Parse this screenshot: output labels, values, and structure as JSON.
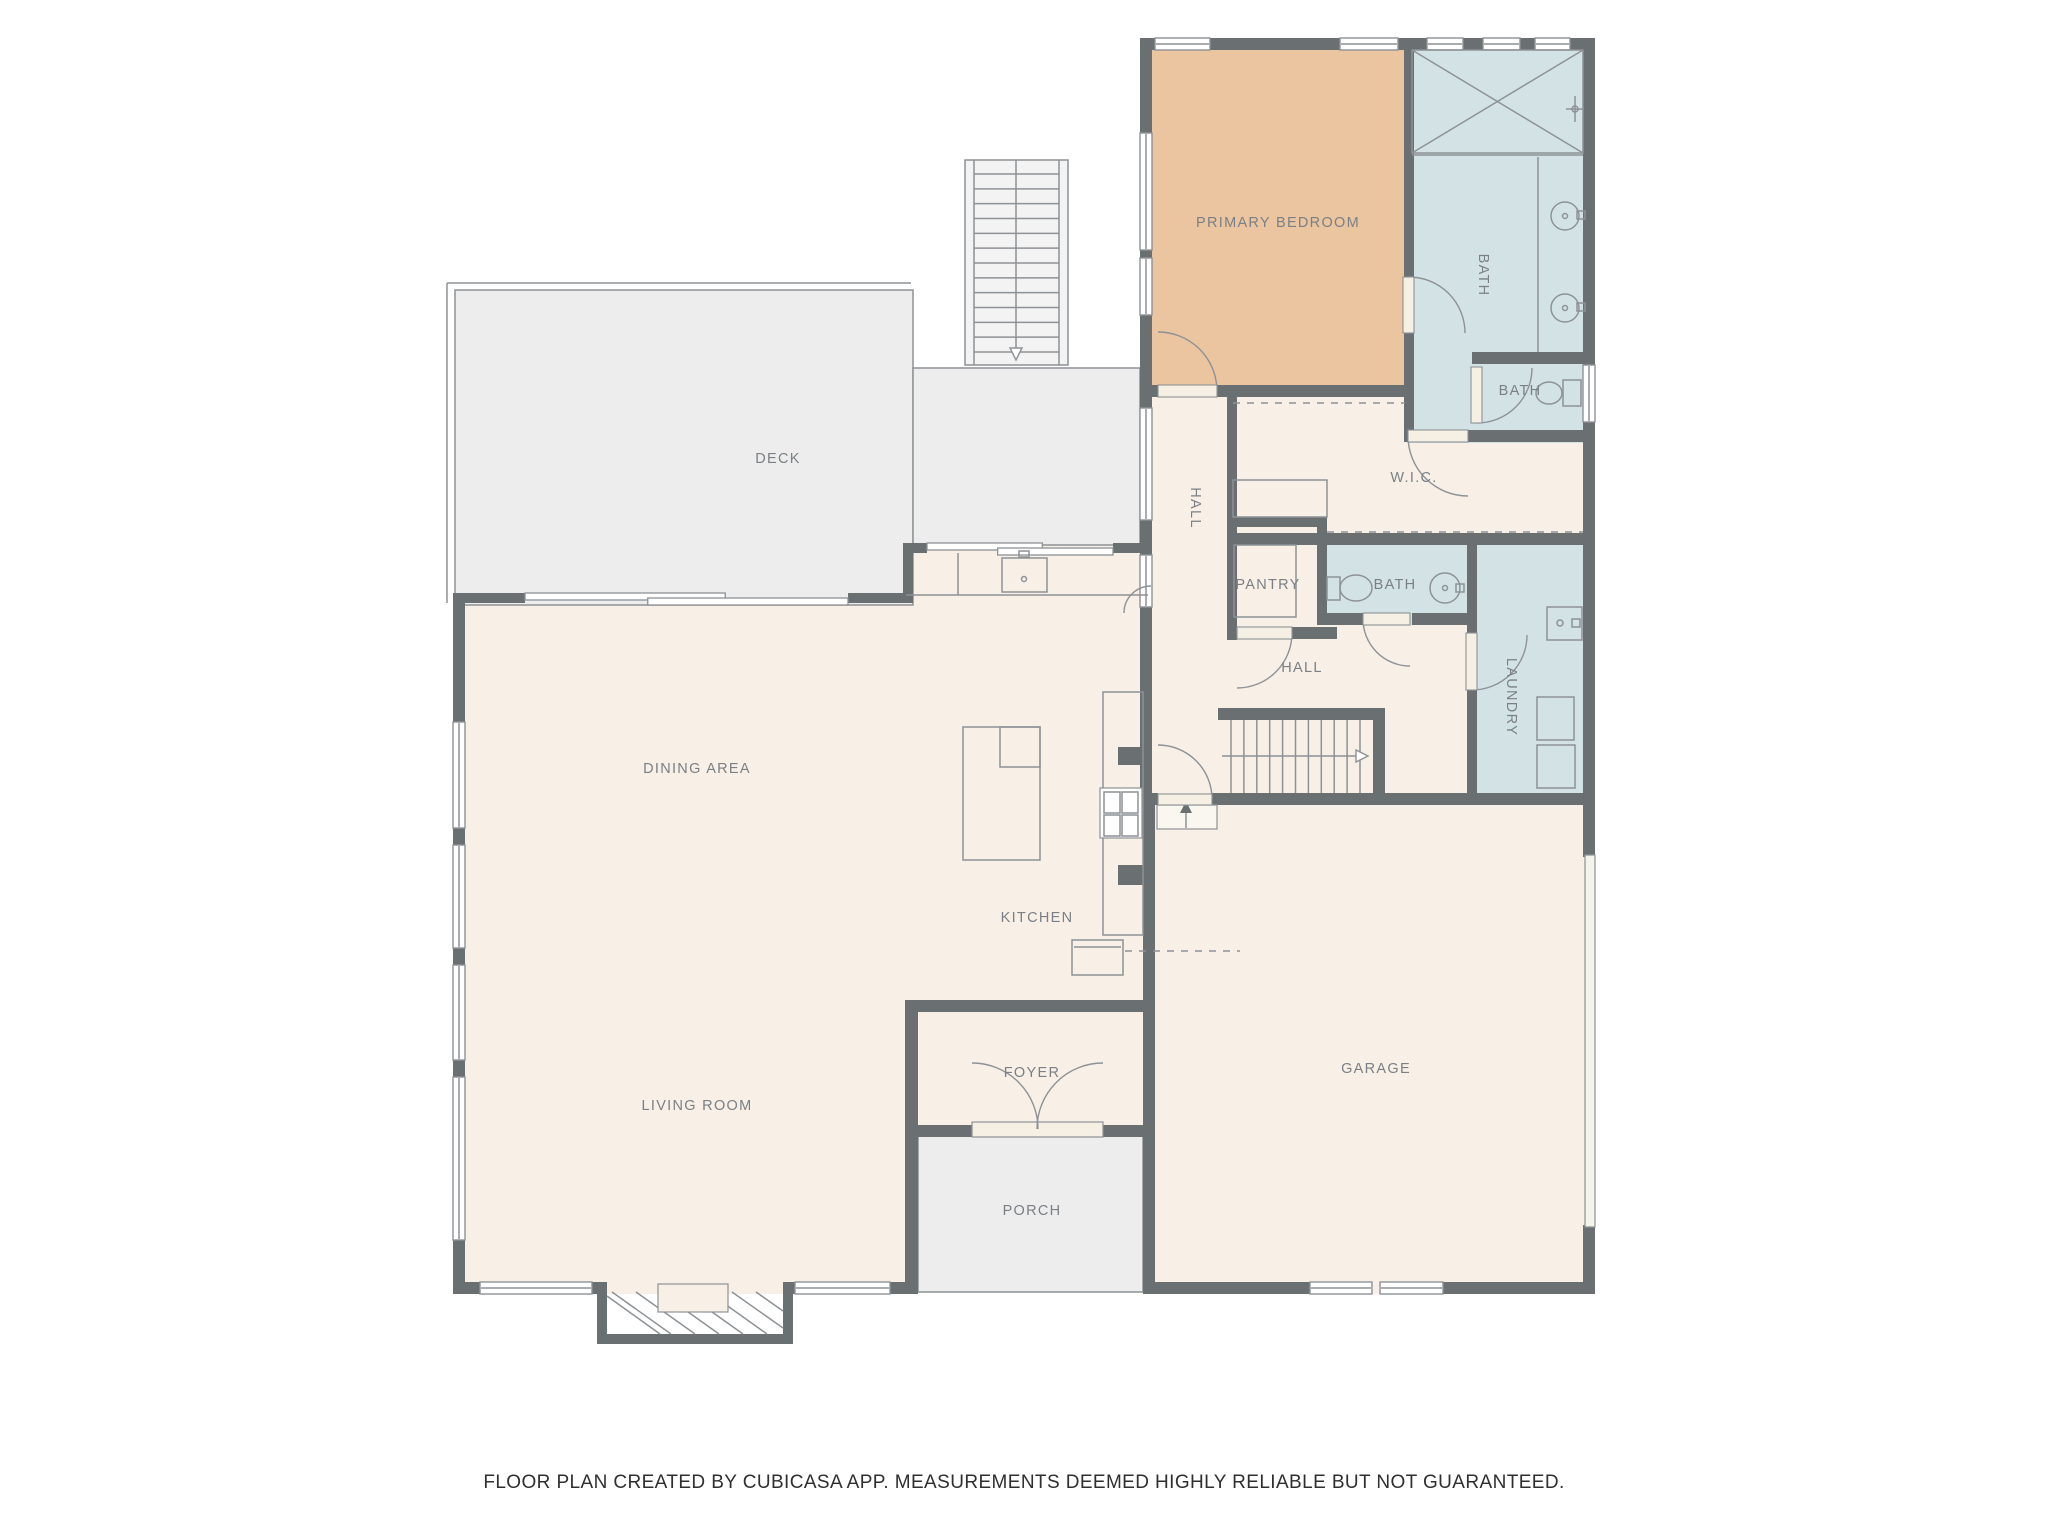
{
  "footer": {
    "text": "FLOOR PLAN CREATED BY CUBICASA APP. MEASUREMENTS DEEMED HIGHLY RELIABLE BUT NOT GUARANTEED."
  },
  "palette": {
    "wall": "#6a6f72",
    "cream": "#f8efe7",
    "tan": "#ebc4a0",
    "blue": "#d3e3e5",
    "gray": "#ededed",
    "stroke": "#8d9296",
    "label": "#7a8085",
    "leaf": "#f6efe3",
    "stairs": "#f3f3f3",
    "landing": "#faf7f1",
    "white": "#ffffff",
    "garagedoor": "#f6f3ed"
  },
  "labels": [
    {
      "n": "label-deck",
      "t": "DECK",
      "x": 778,
      "y": 458
    },
    {
      "n": "label-dining-area",
      "t": "DINING AREA",
      "x": 697,
      "y": 768
    },
    {
      "n": "label-kitchen",
      "t": "KITCHEN",
      "x": 1037,
      "y": 917
    },
    {
      "n": "label-living-room",
      "t": "LIVING ROOM",
      "x": 697,
      "y": 1105
    },
    {
      "n": "label-foyer",
      "t": "FOYER",
      "x": 1032,
      "y": 1072
    },
    {
      "n": "label-porch",
      "t": "PORCH",
      "x": 1032,
      "y": 1210
    },
    {
      "n": "label-garage",
      "t": "GARAGE",
      "x": 1376,
      "y": 1068
    },
    {
      "n": "label-primary-bedroom",
      "t": "PRIMARY BEDROOM",
      "x": 1278,
      "y": 222
    },
    {
      "n": "label-bath-primary",
      "t": "BATH",
      "x": 1484,
      "y": 275,
      "r": 90
    },
    {
      "n": "label-bath-small",
      "t": "BATH",
      "x": 1520,
      "y": 390
    },
    {
      "n": "label-wic",
      "t": "W.I.C.",
      "x": 1414,
      "y": 477
    },
    {
      "n": "label-hall-upper",
      "t": "HALL",
      "x": 1196,
      "y": 508,
      "r": 90
    },
    {
      "n": "label-pantry",
      "t": "PANTRY",
      "x": 1268,
      "y": 584
    },
    {
      "n": "label-bath-hall",
      "t": "BATH",
      "x": 1395,
      "y": 584
    },
    {
      "n": "label-laundry",
      "t": "LAUNDRY",
      "x": 1512,
      "y": 697,
      "r": 90
    },
    {
      "n": "label-hall-lower",
      "t": "HALL",
      "x": 1302,
      "y": 667
    }
  ],
  "fills": [
    {
      "n": "room-living-dining",
      "x": 453,
      "y": 593,
      "w": 465,
      "h": 701,
      "c": "cream"
    },
    {
      "n": "room-kitchen",
      "x": 903,
      "y": 543,
      "w": 252,
      "h": 469,
      "c": "cream"
    },
    {
      "n": "room-foyer",
      "x": 905,
      "y": 1000,
      "w": 250,
      "h": 136,
      "c": "cream"
    },
    {
      "n": "room-garage",
      "x": 1143,
      "y": 793,
      "w": 452,
      "h": 501,
      "c": "cream"
    },
    {
      "n": "room-halls-wic",
      "x": 1140,
      "y": 390,
      "w": 455,
      "h": 420,
      "c": "cream"
    },
    {
      "n": "room-primary-bedroom",
      "x": 1143,
      "y": 40,
      "w": 269,
      "h": 357,
      "c": "tan"
    },
    {
      "n": "room-primary-bath",
      "x": 1407,
      "y": 40,
      "w": 188,
      "h": 403,
      "c": "blue"
    },
    {
      "n": "room-hall-bath",
      "x": 1317,
      "y": 543,
      "w": 160,
      "h": 82,
      "c": "blue"
    },
    {
      "n": "room-laundry",
      "x": 1467,
      "y": 543,
      "w": 128,
      "h": 262,
      "c": "blue"
    },
    {
      "n": "room-deck-main",
      "x": 455,
      "y": 290,
      "w": 458,
      "h": 315,
      "c": "gray",
      "s": 1
    },
    {
      "n": "room-deck-side",
      "x": 913,
      "y": 368,
      "w": 227,
      "h": 177,
      "c": "gray",
      "s": 1
    },
    {
      "n": "room-porch",
      "x": 918,
      "y": 1136,
      "w": 225,
      "h": 156,
      "c": "gray",
      "s": 1
    }
  ],
  "walls": [
    [
      1140,
      38,
      455,
      12
    ],
    [
      1140,
      50,
      12,
      83
    ],
    [
      1140,
      250,
      12,
      8
    ],
    [
      1140,
      315,
      12,
      82
    ],
    [
      1140,
      385,
      18,
      12
    ],
    [
      1217,
      385,
      190,
      12
    ],
    [
      1404,
      50,
      10,
      227
    ],
    [
      1404,
      333,
      10,
      109
    ],
    [
      1583,
      50,
      12,
      315
    ],
    [
      1583,
      422,
      12,
      435
    ],
    [
      1583,
      1225,
      12,
      69
    ],
    [
      1472,
      352,
      123,
      12
    ],
    [
      1468,
      430,
      127,
      12
    ],
    [
      1227,
      390,
      10,
      250
    ],
    [
      1227,
      517,
      100,
      10
    ],
    [
      1317,
      517,
      10,
      108
    ],
    [
      1227,
      627,
      10,
      12
    ],
    [
      1292,
      627,
      45,
      12
    ],
    [
      1237,
      533,
      358,
      12
    ],
    [
      1317,
      613,
      46,
      12
    ],
    [
      1412,
      613,
      55,
      12
    ],
    [
      1467,
      545,
      10,
      88
    ],
    [
      1467,
      690,
      10,
      103
    ],
    [
      1143,
      793,
      15,
      12
    ],
    [
      1212,
      793,
      383,
      12
    ],
    [
      1218,
      708,
      155,
      12
    ],
    [
      1373,
      708,
      12,
      97
    ],
    [
      1140,
      397,
      12,
      11
    ],
    [
      1140,
      520,
      12,
      35
    ],
    [
      1140,
      553,
      12,
      252
    ],
    [
      1118,
      747,
      25,
      18
    ],
    [
      1118,
      865,
      25,
      20
    ],
    [
      1143,
      805,
      12,
      489
    ],
    [
      903,
      543,
      24,
      10
    ],
    [
      1113,
      543,
      39,
      10
    ],
    [
      903,
      543,
      10,
      60
    ],
    [
      455,
      593,
      70,
      10
    ],
    [
      848,
      593,
      65,
      10
    ],
    [
      453,
      593,
      12,
      129
    ],
    [
      453,
      828,
      12,
      17
    ],
    [
      453,
      948,
      12,
      17
    ],
    [
      453,
      1060,
      12,
      17
    ],
    [
      453,
      1240,
      12,
      54
    ],
    [
      453,
      1282,
      27,
      12
    ],
    [
      592,
      1282,
      10,
      12
    ],
    [
      790,
      1282,
      5,
      12
    ],
    [
      890,
      1282,
      28,
      12
    ],
    [
      905,
      1000,
      250,
      12
    ],
    [
      905,
      1012,
      13,
      282
    ],
    [
      905,
      1125,
      67,
      12
    ],
    [
      1103,
      1125,
      52,
      12
    ],
    [
      1155,
      1282,
      155,
      12
    ],
    [
      1443,
      1282,
      152,
      12
    ],
    [
      597,
      1282,
      10,
      62
    ],
    [
      783,
      1282,
      10,
      62
    ],
    [
      597,
      1334,
      196,
      10
    ]
  ],
  "windows": [
    [
      1155,
      38,
      55,
      12,
      "h"
    ],
    [
      1340,
      38,
      58,
      12,
      "h"
    ],
    [
      1427,
      38,
      36,
      12,
      "h"
    ],
    [
      1483,
      38,
      37,
      12,
      "h"
    ],
    [
      1535,
      38,
      35,
      12,
      "h"
    ],
    [
      1140,
      133,
      12,
      117,
      "v"
    ],
    [
      1140,
      258,
      12,
      57,
      "v"
    ],
    [
      1140,
      408,
      12,
      112,
      "v"
    ],
    [
      1140,
      555,
      12,
      52,
      "v"
    ],
    [
      1583,
      365,
      12,
      57,
      "v"
    ],
    [
      453,
      722,
      12,
      106,
      "v"
    ],
    [
      453,
      845,
      12,
      103,
      "v"
    ],
    [
      453,
      965,
      12,
      95,
      "v"
    ],
    [
      453,
      1077,
      12,
      163,
      "v"
    ],
    [
      480,
      1282,
      112,
      12,
      "h"
    ],
    [
      795,
      1282,
      95,
      12,
      "h"
    ],
    [
      1310,
      1282,
      62,
      12,
      "h"
    ],
    [
      1380,
      1282,
      63,
      12,
      "h"
    ]
  ],
  "sliders": [
    {
      "n": "sliding-door-dining-deck",
      "x": 525,
      "y": 594,
      "len": 323
    },
    {
      "n": "sliding-door-kitchen-deck",
      "x": 927,
      "y": 544,
      "len": 186
    }
  ],
  "doors": [
    {
      "n": "door-primary-bedroom",
      "cx": 1158,
      "cy": 391,
      "r": 59,
      "a0": -90,
      "a1": 0,
      "sw": 1,
      "leaf": [
        1158,
        385,
        59,
        12
      ]
    },
    {
      "n": "door-primary-bath",
      "cx": 1409,
      "cy": 333,
      "r": 56,
      "a0": -90,
      "a1": 0,
      "sw": 1,
      "leaf": [
        1403,
        277,
        11,
        56
      ]
    },
    {
      "n": "door-bath-small",
      "cx": 1477,
      "cy": 368,
      "r": 55,
      "a0": 90,
      "a1": 0,
      "sw": 0,
      "leaf": [
        1471,
        367,
        11,
        56
      ]
    },
    {
      "n": "door-wic",
      "cx": 1468,
      "cy": 436,
      "r": 60,
      "a0": 180,
      "a1": 90,
      "sw": 0,
      "leaf": [
        1408,
        430,
        60,
        12
      ]
    },
    {
      "n": "door-pantry",
      "cx": 1237,
      "cy": 633,
      "r": 55,
      "a0": 0,
      "a1": 90,
      "sw": 1,
      "leaf": [
        1237,
        627,
        55,
        12
      ]
    },
    {
      "n": "door-hall-bath",
      "cx": 1410,
      "cy": 619,
      "r": 47,
      "a0": 180,
      "a1": 90,
      "sw": 0,
      "leaf": [
        1363,
        613,
        47,
        12
      ]
    },
    {
      "n": "door-laundry",
      "cx": 1472,
      "cy": 635,
      "r": 55,
      "a0": 90,
      "a1": 0,
      "sw": 0,
      "leaf": [
        1466,
        633,
        11,
        57
      ]
    },
    {
      "n": "door-garage-hall",
      "cx": 1158,
      "cy": 799,
      "r": 54,
      "a0": 0,
      "a1": -90,
      "sw": 0,
      "leaf": [
        1158,
        794,
        54,
        11
      ]
    },
    {
      "n": "door-front-left",
      "cx": 972,
      "cy": 1129,
      "r": 66,
      "a0": -90,
      "a1": 0,
      "sw": 1,
      "leaf": null
    },
    {
      "n": "door-front-right",
      "cx": 1103,
      "cy": 1129,
      "r": 66,
      "a0": -90,
      "a1": 180,
      "sw": 0,
      "leaf": null
    },
    {
      "n": "door-kitchen-hall",
      "cx": 1151,
      "cy": 613,
      "r": 27,
      "a0": 180,
      "a1": -90,
      "sw": 1,
      "leaf": null
    }
  ],
  "prims": [
    {
      "t": "l",
      "p": [
        447,
        283,
        447,
        603
      ],
      "n": "deck-railing"
    },
    {
      "t": "l",
      "p": [
        447,
        283,
        911,
        283
      ],
      "n": "deck-railing"
    },
    {
      "t": "r",
      "p": [
        1412,
        50,
        171,
        103
      ],
      "n": "shower"
    },
    {
      "t": "l",
      "p": [
        1412,
        50,
        1583,
        153
      ],
      "n": "shower"
    },
    {
      "t": "l",
      "p": [
        1583,
        50,
        1412,
        153
      ],
      "n": "shower"
    },
    {
      "t": "l",
      "p": [
        1412,
        155,
        1583,
        155
      ],
      "n": "shower"
    },
    {
      "t": "l",
      "p": [
        1575,
        96,
        1575,
        122
      ],
      "n": "shower-head-icon"
    },
    {
      "t": "l",
      "p": [
        1566,
        109,
        1584,
        109
      ],
      "n": "shower-head-icon"
    },
    {
      "t": "c",
      "p": [
        1575,
        109,
        3
      ],
      "n": "shower-head-icon"
    },
    {
      "t": "l",
      "p": [
        1538,
        157,
        1538,
        352
      ],
      "n": "vanity"
    },
    {
      "t": "c",
      "p": [
        1565,
        216,
        14
      ],
      "n": "sink"
    },
    {
      "t": "c",
      "p": [
        1565,
        216,
        2.5
      ],
      "n": "sink"
    },
    {
      "t": "r",
      "p": [
        1577,
        211,
        8,
        8
      ],
      "n": "faucet-icon"
    },
    {
      "t": "c",
      "p": [
        1565,
        308,
        14
      ],
      "n": "sink"
    },
    {
      "t": "c",
      "p": [
        1565,
        308,
        2.5
      ],
      "n": "sink"
    },
    {
      "t": "r",
      "p": [
        1577,
        303,
        8,
        8
      ],
      "n": "faucet-icon"
    },
    {
      "t": "r",
      "p": [
        1563,
        380,
        18,
        26
      ],
      "n": "toilet"
    },
    {
      "t": "e",
      "p": [
        1549,
        393,
        13,
        11
      ],
      "n": "toilet"
    },
    {
      "t": "r",
      "p": [
        1327,
        577,
        13,
        23
      ],
      "n": "toilet"
    },
    {
      "t": "e",
      "p": [
        1356,
        588,
        16,
        13
      ],
      "n": "toilet"
    },
    {
      "t": "c",
      "p": [
        1445,
        588,
        15
      ],
      "n": "sink"
    },
    {
      "t": "c",
      "p": [
        1445,
        588,
        2.5
      ],
      "n": "sink"
    },
    {
      "t": "r",
      "p": [
        1456,
        584,
        8,
        8
      ],
      "n": "faucet-icon"
    },
    {
      "t": "r",
      "p": [
        1547,
        607,
        35,
        33
      ],
      "n": "laundry-sink"
    },
    {
      "t": "c",
      "p": [
        1560,
        623,
        3
      ],
      "n": "laundry-sink"
    },
    {
      "t": "r",
      "p": [
        1572,
        619,
        8,
        8
      ],
      "n": "faucet-icon"
    },
    {
      "t": "r",
      "p": [
        1537,
        697,
        37,
        43
      ],
      "n": "washer"
    },
    {
      "t": "r",
      "p": [
        1537,
        745,
        38,
        43
      ],
      "n": "dryer"
    },
    {
      "t": "ld",
      "p": [
        1233,
        403,
        1405,
        403
      ],
      "n": "closet-rod"
    },
    {
      "t": "ld",
      "p": [
        1327,
        532,
        1583,
        532
      ],
      "n": "closet-rod"
    },
    {
      "t": "r",
      "p": [
        1233,
        480,
        94,
        37
      ],
      "n": "closet-shelf"
    },
    {
      "t": "r",
      "p": [
        1234,
        545,
        62,
        72
      ],
      "n": "pantry-shelf"
    },
    {
      "t": "l",
      "p": [
        906,
        595,
        1148,
        595
      ],
      "n": "kitchen-counter"
    },
    {
      "t": "l",
      "p": [
        958,
        553,
        958,
        595
      ],
      "n": "kitchen-counter"
    },
    {
      "t": "r",
      "p": [
        1002,
        558,
        45,
        34
      ],
      "n": "kitchen-sink"
    },
    {
      "t": "r",
      "p": [
        1019,
        551,
        10,
        6
      ],
      "n": "faucet-icon"
    },
    {
      "t": "c",
      "p": [
        1024,
        579,
        2.5
      ],
      "n": "kitchen-sink"
    },
    {
      "t": "r",
      "p": [
        963,
        727,
        77,
        133
      ],
      "n": "kitchen-island"
    },
    {
      "t": "r",
      "p": [
        1000,
        727,
        40,
        40
      ],
      "n": "kitchen-island"
    },
    {
      "t": "r",
      "p": [
        1103,
        692,
        40,
        243
      ],
      "n": "kitchen-counter"
    },
    {
      "t": "rf",
      "p": [
        1100,
        788,
        42,
        50
      ],
      "f": "#ffffff",
      "n": "stove"
    },
    {
      "t": "r",
      "p": [
        1104,
        792,
        16,
        21
      ],
      "n": "stove-burner"
    },
    {
      "t": "r",
      "p": [
        1122,
        792,
        16,
        21
      ],
      "n": "stove-burner"
    },
    {
      "t": "r",
      "p": [
        1104,
        815,
        16,
        21
      ],
      "n": "stove-burner"
    },
    {
      "t": "r",
      "p": [
        1122,
        815,
        16,
        21
      ],
      "n": "stove-burner"
    },
    {
      "t": "r",
      "p": [
        1072,
        940,
        51,
        35
      ],
      "n": "fridge"
    },
    {
      "t": "l",
      "p": [
        1074,
        947,
        1121,
        947
      ],
      "n": "fridge"
    },
    {
      "t": "ld",
      "p": [
        1125,
        951,
        1240,
        951
      ],
      "n": "ceiling-break-line"
    },
    {
      "t": "rf",
      "p": [
        1157,
        805,
        60,
        24
      ],
      "f": "#faf7f1",
      "n": "stair-landing"
    },
    {
      "t": "l",
      "p": [
        1186,
        828,
        1186,
        808
      ],
      "n": "up-arrow-icon"
    },
    {
      "t": "pf",
      "p": [
        "M1180,813 L1186,801 L1192,813 Z"
      ],
      "f": "#6a6f72",
      "n": "up-arrow-icon"
    },
    {
      "t": "l",
      "p": [
        612,
        1292,
        671,
        1334
      ],
      "n": "fireplace-hatch"
    },
    {
      "t": "l",
      "p": [
        636,
        1292,
        695,
        1334
      ],
      "n": "fireplace-hatch"
    },
    {
      "t": "l",
      "p": [
        660,
        1292,
        719,
        1334
      ],
      "n": "fireplace-hatch"
    },
    {
      "t": "l",
      "p": [
        684,
        1292,
        743,
        1334
      ],
      "n": "fireplace-hatch"
    },
    {
      "t": "l",
      "p": [
        708,
        1292,
        767,
        1334
      ],
      "n": "fireplace-hatch"
    },
    {
      "t": "l",
      "p": [
        732,
        1292,
        783,
        1328
      ],
      "n": "fireplace-hatch"
    },
    {
      "t": "l",
      "p": [
        756,
        1292,
        783,
        1311
      ],
      "n": "fireplace-hatch"
    },
    {
      "t": "l",
      "p": [
        607,
        1296,
        660,
        1334
      ],
      "n": "fireplace-hatch"
    },
    {
      "t": "rf",
      "p": [
        658,
        1284,
        70,
        28
      ],
      "f": "#f8efe7",
      "n": "firebox"
    },
    {
      "t": "rf",
      "p": [
        1585,
        855,
        10,
        372
      ],
      "f": "#f6f3ed",
      "n": "garage-door"
    },
    {
      "t": "rf",
      "p": [
        972,
        1122,
        131,
        15
      ],
      "f": "#f6efe3",
      "n": "front-door-threshold"
    }
  ],
  "stairs": [
    {
      "n": "stairs-deck",
      "rect": [
        965,
        160,
        103,
        205
      ],
      "fill": "#f3f3f3",
      "rails": [
        974,
        1059
      ],
      "steps": {
        "dir": "h",
        "a1": 974,
        "a2": 1059,
        "b1": 174,
        "b2": 352,
        "count": 13
      },
      "center": [
        "v",
        1016,
        160,
        352
      ],
      "arrow": "M1010,348 L1022,348 L1016,360 Z"
    },
    {
      "n": "stairs-main",
      "rect": null,
      "fill": null,
      "rails": null,
      "steps": {
        "dir": "v",
        "a1": 720,
        "a2": 793,
        "b1": 1231,
        "b2": 1360,
        "count": 11
      },
      "center": [
        "h",
        756,
        1222,
        1356
      ],
      "arrow": "M1356,750 L1368,756 L1356,762 Z"
    }
  ]
}
